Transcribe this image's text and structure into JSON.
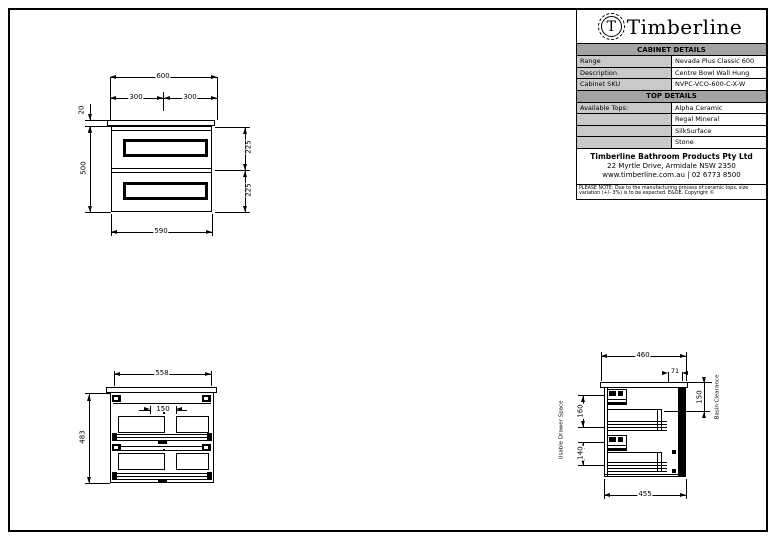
{
  "colors": {
    "line": "#000000",
    "header_bg": "#a3a3a3",
    "label_cell_bg": "#c9c9c9",
    "paper": "#ffffff"
  },
  "title_block": {
    "logo_letter": "T",
    "brand": "Timberline",
    "cabinet_details_header": "CABINET DETAILS",
    "rows": [
      {
        "label": "Range",
        "value": "Nevada Plus Classic 600"
      },
      {
        "label": "Description",
        "value": "Centre Bowl Wall Hung"
      },
      {
        "label": "Cabinet SKU",
        "value": "NVPC-VCO-600-C-X-W"
      }
    ],
    "top_details_header": "TOP DETAILS",
    "tops_label": "Available Tops:",
    "tops": [
      "Alpha Ceramic",
      "Regal Mineral",
      "SilkSurface",
      "Stone"
    ],
    "company": {
      "name": "Timberline Bathroom Products Pty Ltd",
      "address": "22 Myrtle Drive, Armidale NSW 2350",
      "contact": "www.timberline.com.au  |  02 6773 8500"
    },
    "note": "PLEASE NOTE: Due to the manufacturing process of ceramic tops, size variation (+/- 3%) is to be expected. E&OE. Copyright ©"
  },
  "front_view": {
    "overall_width": "600",
    "left_half": "300",
    "right_half": "300",
    "benchtop_thickness": "20",
    "cabinet_height": "500",
    "drawer_front_top": "225",
    "drawer_front_bottom": "225",
    "carcass_width": "590"
  },
  "internal_view": {
    "internal_width": "558",
    "plumbing_gap": "150",
    "internal_height": "483"
  },
  "side_view": {
    "depth_overall": "460",
    "rear_offset": "71",
    "basin_clearance": "150",
    "basin_clearance_label": "Basin Clearance",
    "usable_drawer_space_label": "Usable Drawer Space",
    "top_drawer_depth": "160",
    "bottom_drawer_depth": "140",
    "carcass_depth": "455"
  }
}
